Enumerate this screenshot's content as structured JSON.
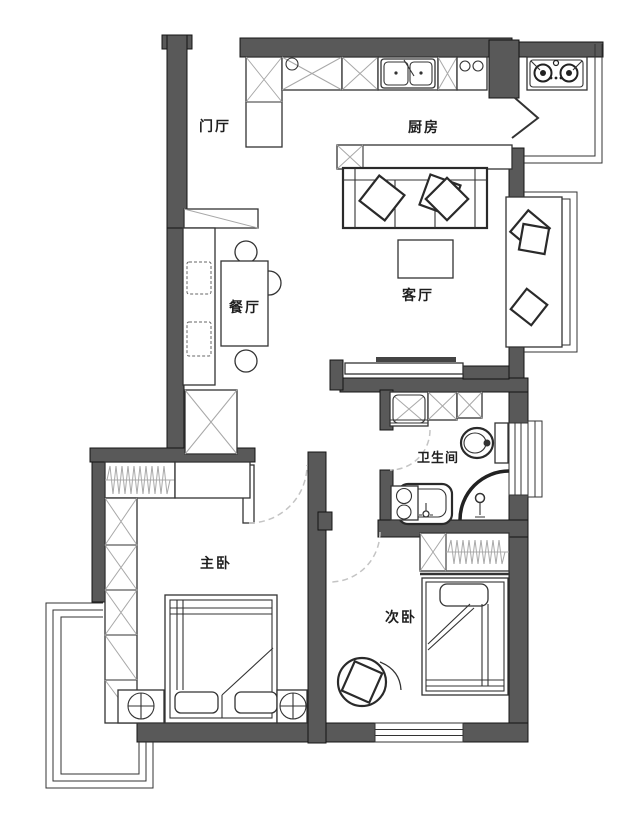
{
  "rooms": {
    "entry_hall": {
      "label": "门厅"
    },
    "kitchen": {
      "label": "厨房"
    },
    "dining": {
      "label": "餐厅"
    },
    "living": {
      "label": "客厅"
    },
    "bathroom": {
      "label": "卫生间"
    },
    "master_bedroom": {
      "label": "主卧"
    },
    "second_bedroom": {
      "label": "次卧"
    }
  },
  "colors": {
    "wall_fill": "#595959",
    "wall_stroke": "#141414",
    "furniture_line": "#333333",
    "hatch_line": "#a8a8a8",
    "door_swing_dash": "#c4c4c4",
    "label_text": "#1f1f1f",
    "background": "#ffffff"
  }
}
